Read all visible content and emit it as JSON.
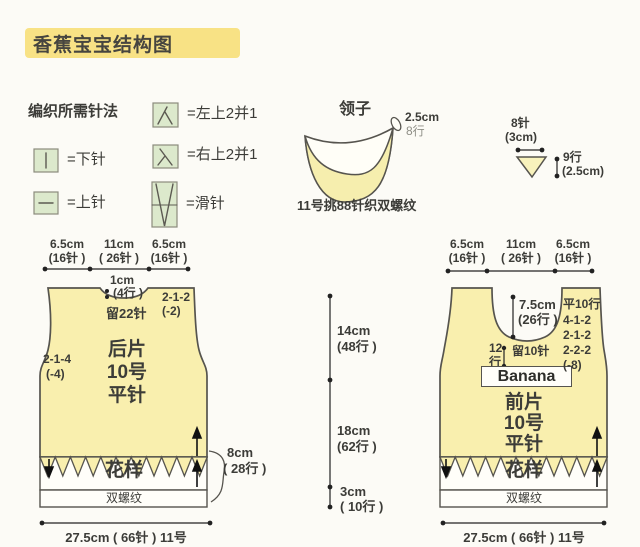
{
  "title": "香蕉宝宝结构图",
  "legend": {
    "header": "编织所需针法",
    "items": [
      {
        "label": "=左上2并1"
      },
      {
        "label": "=下针"
      },
      {
        "label": "=右上2并1"
      },
      {
        "label": "=上针"
      },
      {
        "label": "=滑针"
      }
    ]
  },
  "collar": {
    "title": "领子",
    "width": "2.5cm",
    "rows": "8行",
    "note": "11号挑88针织双螺纹"
  },
  "gusset": {
    "stitches": "8针",
    "width": "(3cm)",
    "rows": "9行",
    "height": "(2.5cm)"
  },
  "center_dims": {
    "seg1_size": "14cm",
    "seg1_rows": "(48行 )",
    "seg2_size": "18cm",
    "seg2_rows": "(62行 )",
    "seg3_size": "3cm",
    "seg3_rows": "( 10行 )"
  },
  "back_piece": {
    "dim_left_size": "6.5cm",
    "dim_left_st": "(16针 )",
    "dim_mid_size": "11cm",
    "dim_mid_st": "( 26针 )",
    "dim_right_size": "6.5cm",
    "dim_right_st": "(16针 )",
    "neck_size": "1cm",
    "neck_rows": "(4行 )",
    "neck_hold": "留22针",
    "shoulder_line1": "2-1-2",
    "shoulder_line2": "(-2)",
    "armhole_line1": "2-1-4",
    "armhole_line2": "(-4)",
    "name1": "后片",
    "name2": "10号",
    "name3": "平针",
    "pattern": "花样",
    "rib": "双螺纹",
    "band_size": "8cm",
    "band_rows": "( 28行 )",
    "bottom": "27.5cm ( 66针 )  11号"
  },
  "front_piece": {
    "dim_left_size": "6.5cm",
    "dim_left_st": "(16针 )",
    "dim_mid_size": "11cm",
    "dim_mid_st": "( 26针 )",
    "dim_right_size": "6.5cm",
    "dim_right_st": "(16针 )",
    "neck_size": "7.5cm",
    "neck_rows": "(26行 )",
    "placket1": "12",
    "placket2": "行",
    "neck_hold": "留10针",
    "logo": "Banana",
    "shaping": [
      "平10行",
      "4-1-2",
      "2-1-2",
      "2-2-2",
      "(-8)"
    ],
    "name1": "前片",
    "name2": "10号",
    "name3": "平针",
    "pattern": "花样",
    "rib": "双螺纹",
    "bottom": "27.5cm ( 66针 )  11号"
  }
}
